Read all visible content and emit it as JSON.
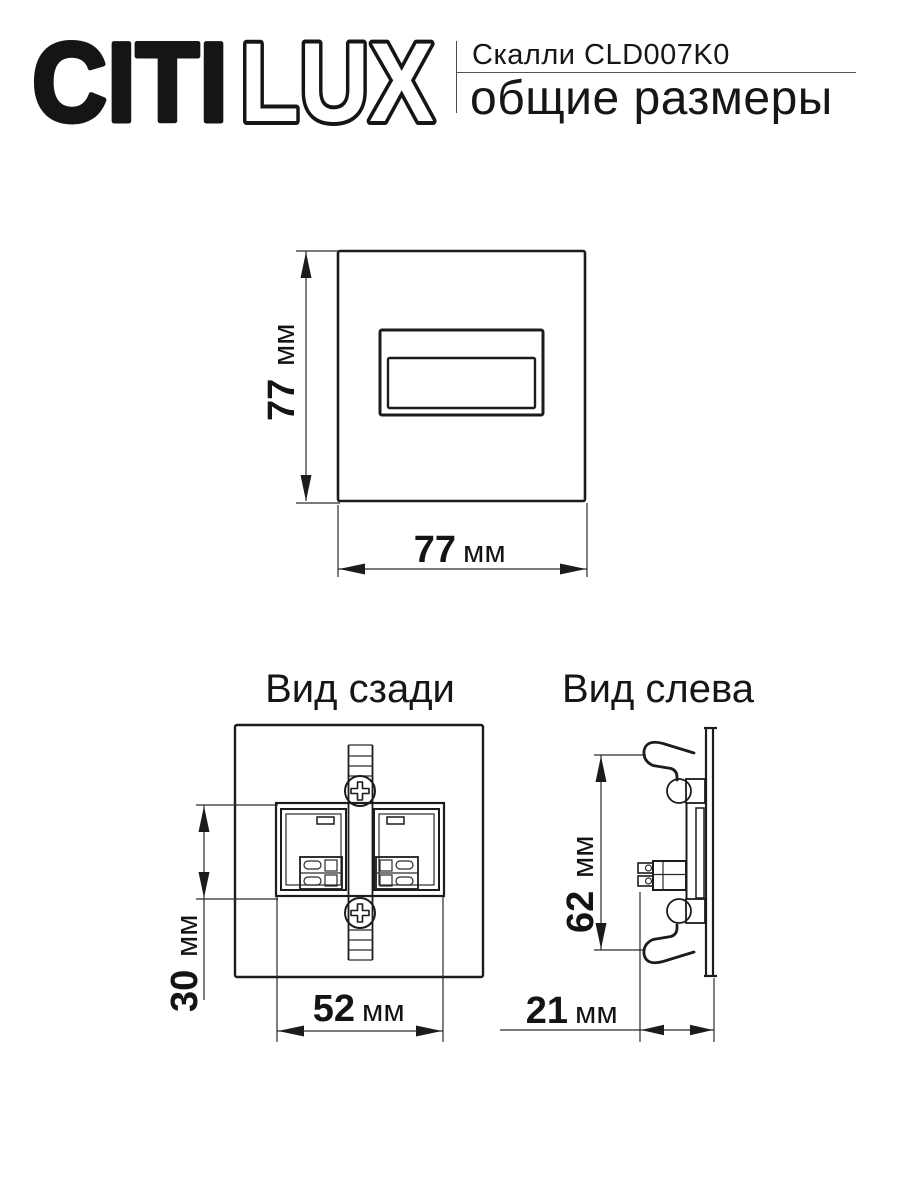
{
  "header": {
    "logo": {
      "solid": "CITI",
      "outline": "LUX"
    },
    "product": "Скалли CLD007K0",
    "subtitle": "общие размеры"
  },
  "views": {
    "front": {
      "height": {
        "value": "77",
        "unit": "мм"
      },
      "width": {
        "value": "77",
        "unit": "мм"
      }
    },
    "rear": {
      "title": "Вид сзади",
      "inner_height": {
        "value": "30",
        "unit": "мм"
      },
      "inner_width": {
        "value": "52",
        "unit": "мм"
      }
    },
    "left": {
      "title": "Вид слева",
      "height": {
        "value": "62",
        "unit": "мм"
      },
      "depth": {
        "value": "21",
        "unit": "мм"
      }
    }
  },
  "colors": {
    "ink": "#1b1b1b",
    "background": "#ffffff"
  }
}
